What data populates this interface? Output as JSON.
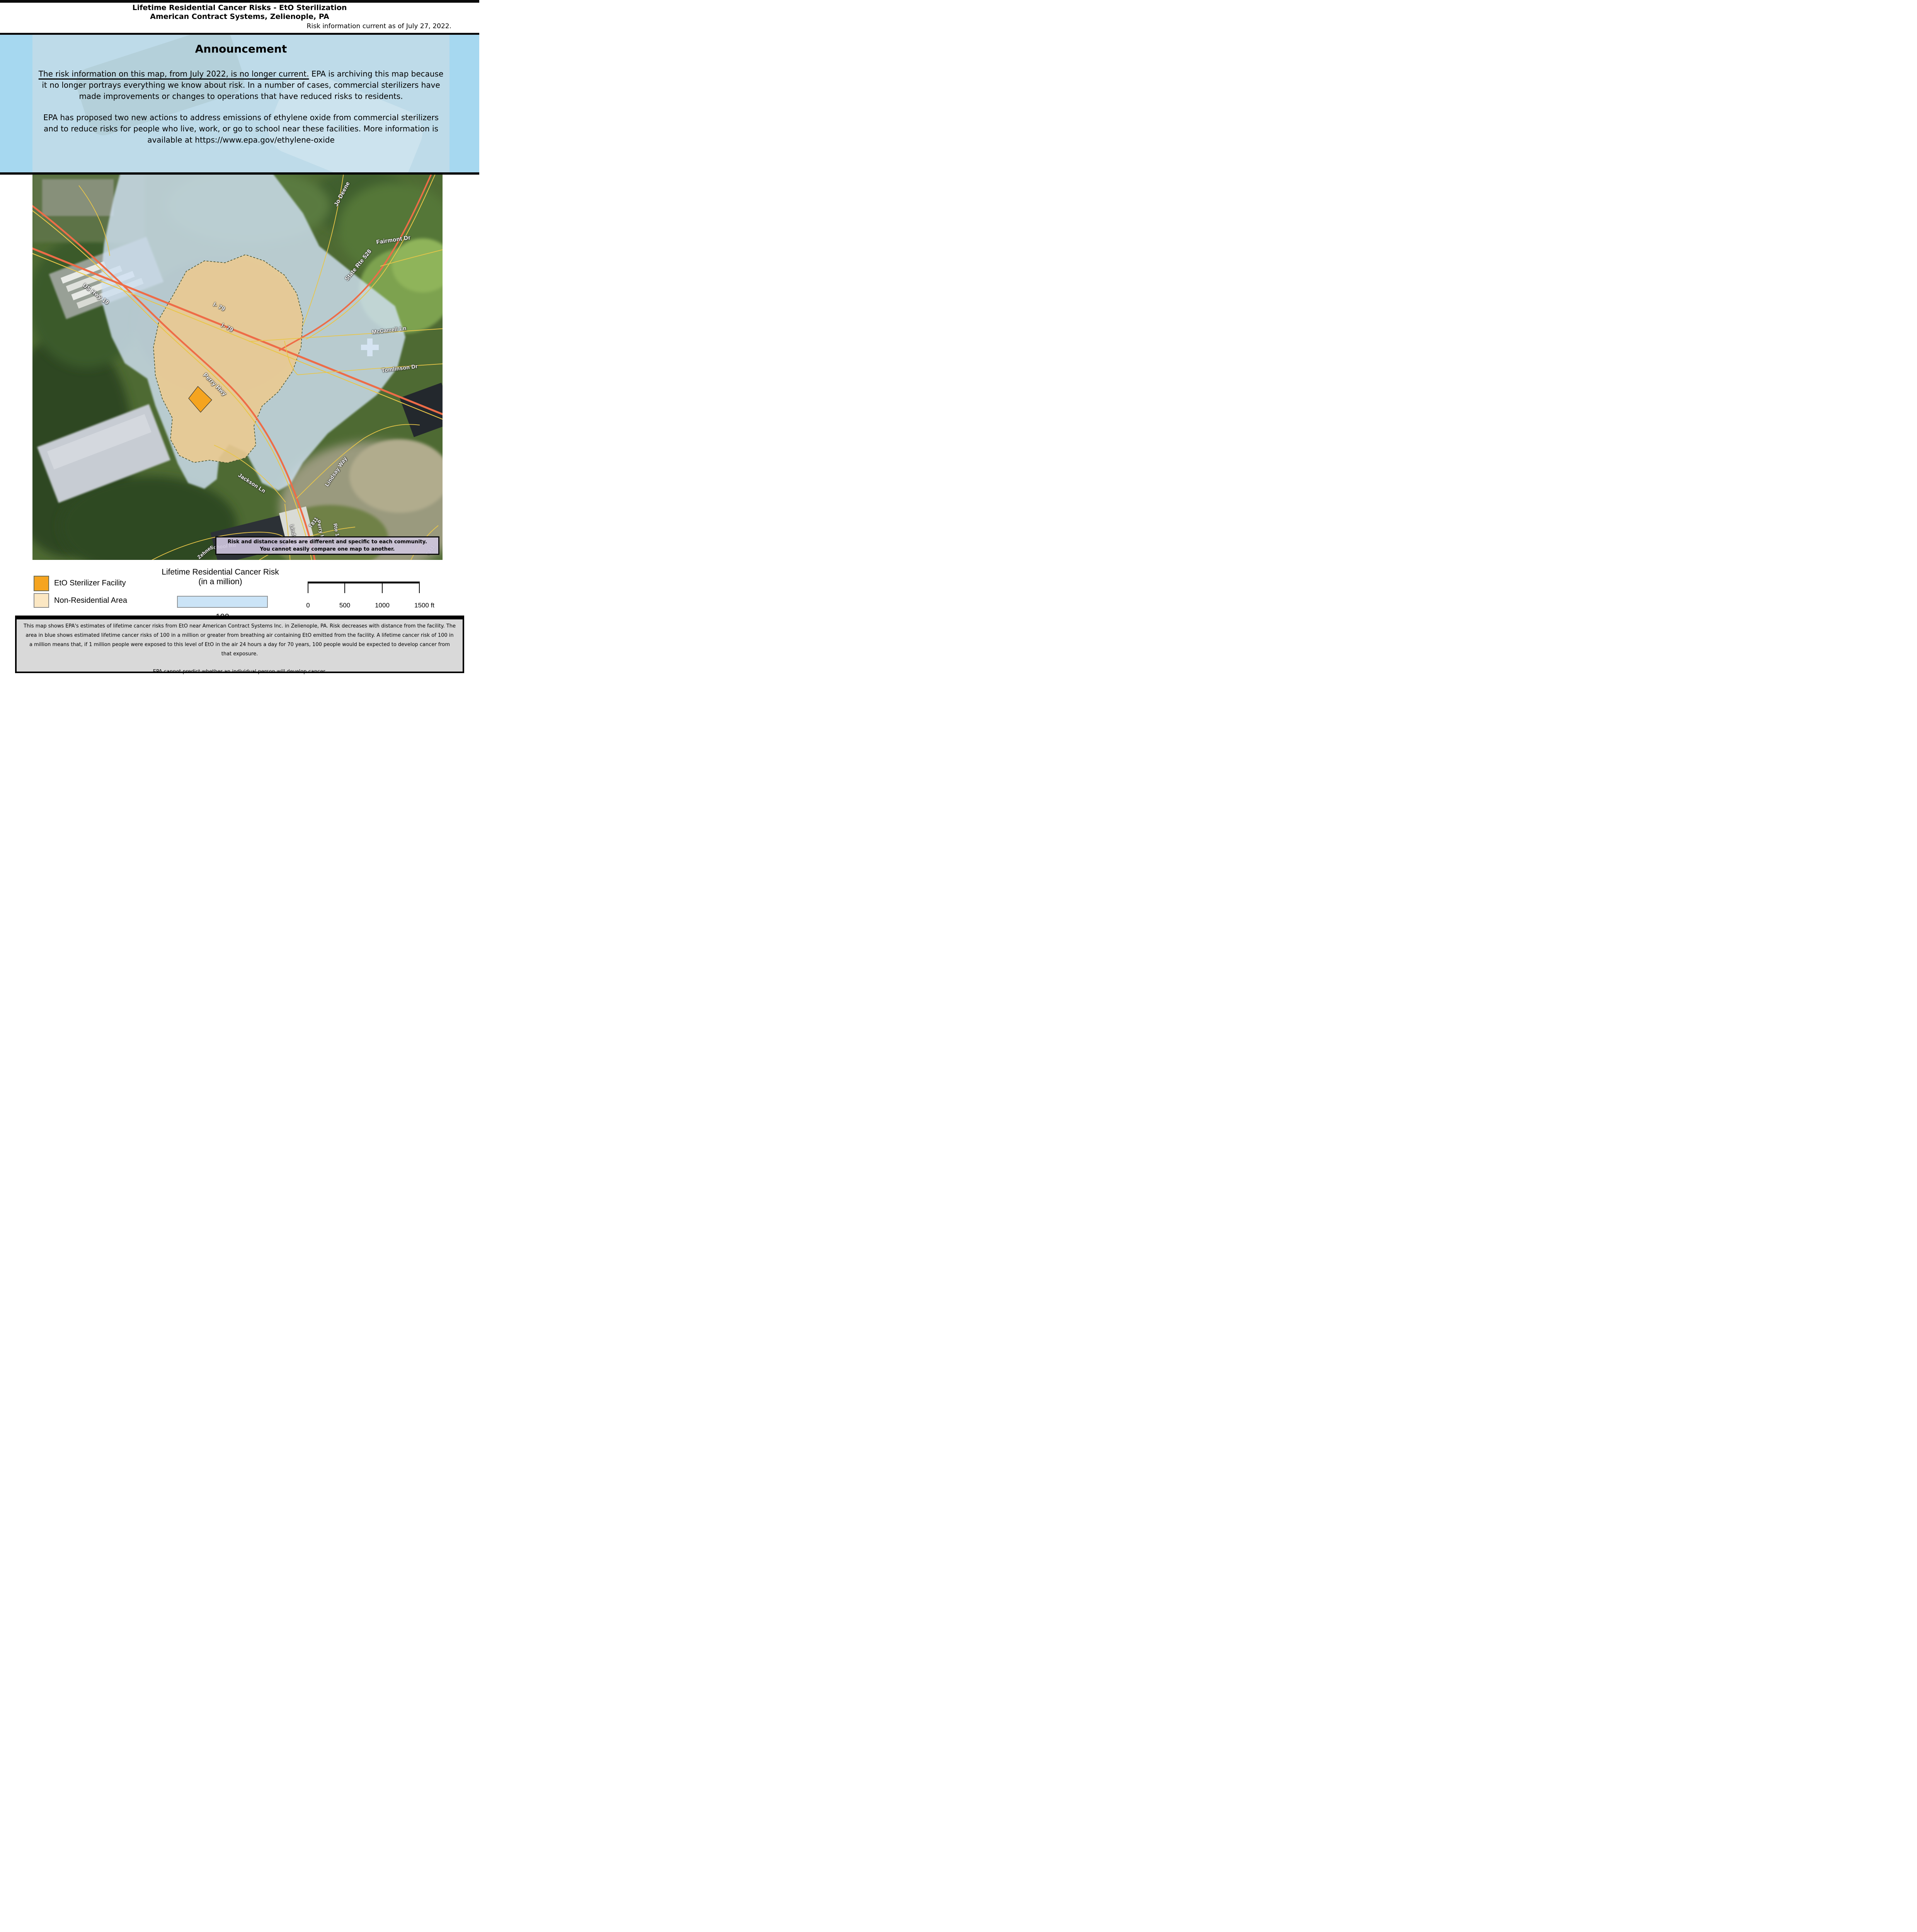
{
  "header": {
    "title_line1": "Lifetime Residential Cancer Risks - EtO Sterilization",
    "title_line2": "American Contract Systems, Zelienople, PA",
    "date_note": "Risk information current as of July 27, 2022."
  },
  "announcement": {
    "heading": "Announcement",
    "para1_underlined": "The risk information on this map, from July 2022, is no longer current.",
    "para1_rest": " EPA is archiving this map because it no longer portrays everything we know about risk. In a number of cases, commercial sterilizers have made improvements or changes to operations that have reduced risks to residents.",
    "para2": "EPA has proposed two new actions to address emissions of ethylene oxide from commercial sterilizers and to reduce risks for people who live, work, or go to school near these facilities. More information is available at https://www.epa.gov/ethylene-oxide"
  },
  "map": {
    "road_labels": [
      {
        "text": "Jo Deene"
      },
      {
        "text": "Fairmont Dr"
      },
      {
        "text": "State Rte 528"
      },
      {
        "text": "US Hwy 19"
      },
      {
        "text": "I- 79"
      },
      {
        "text": "I- 79"
      },
      {
        "text": "Perry Hwy"
      },
      {
        "text": "McCarrell Ln"
      },
      {
        "text": "Tomlinson Dr"
      },
      {
        "text": "Jackson Ln"
      },
      {
        "text": "Lindsay Way"
      },
      {
        "text": "Lindsay Rd"
      },
      {
        "text": "Perry Hwy"
      },
      {
        "text": "T811"
      },
      {
        "text": "Rte 19"
      },
      {
        "text": "Zehner"
      },
      {
        "text": "School Rd"
      },
      {
        "text": "T311"
      }
    ],
    "notice_box": {
      "line1": "Risk and distance scales are different and specific to each community.",
      "line2": "You cannot easily compare one map to another."
    }
  },
  "legend": {
    "items": [
      {
        "label": "EtO Sterilizer Facility",
        "color": "#F5A41F"
      },
      {
        "label": "Non-Residential Area",
        "color": "#FBE7C3"
      }
    ],
    "risk_title_line1": "Lifetime Residential Cancer Risk",
    "risk_title_line2": "(in a million)",
    "risk_value": "100",
    "risk_swatch_color": "#CBE4F7"
  },
  "scalebar": {
    "labels": [
      "0",
      "500",
      "1000",
      "1500 ft"
    ]
  },
  "footer": {
    "para1": "This map shows EPA's estimates of lifetime cancer risks from EtO near American Contract Systems Inc. in Zelienople, PA. Risk decreases with distance from the facility. The area in blue shows estimated lifetime cancer risks of 100 in a million or greater from breathing air containing EtO emitted from the facility. A lifetime cancer risk of 100 in a million means that, if 1 million people were exposed to this level of EtO in the air 24 hours a day for 70 years, 100 people would be expected to develop cancer from that exposure.",
    "para2": "EPA cannot predict whether an individual person will develop cancer."
  },
  "colors": {
    "announcement_bg": "#A6D8F0",
    "risk_area_blue": "#CFE0F2",
    "nonresidential_tan": "#E8C992",
    "facility_orange": "#F5A41F",
    "notice_purple": "#CFC6DF",
    "footer_gray": "#D9D9D9"
  }
}
